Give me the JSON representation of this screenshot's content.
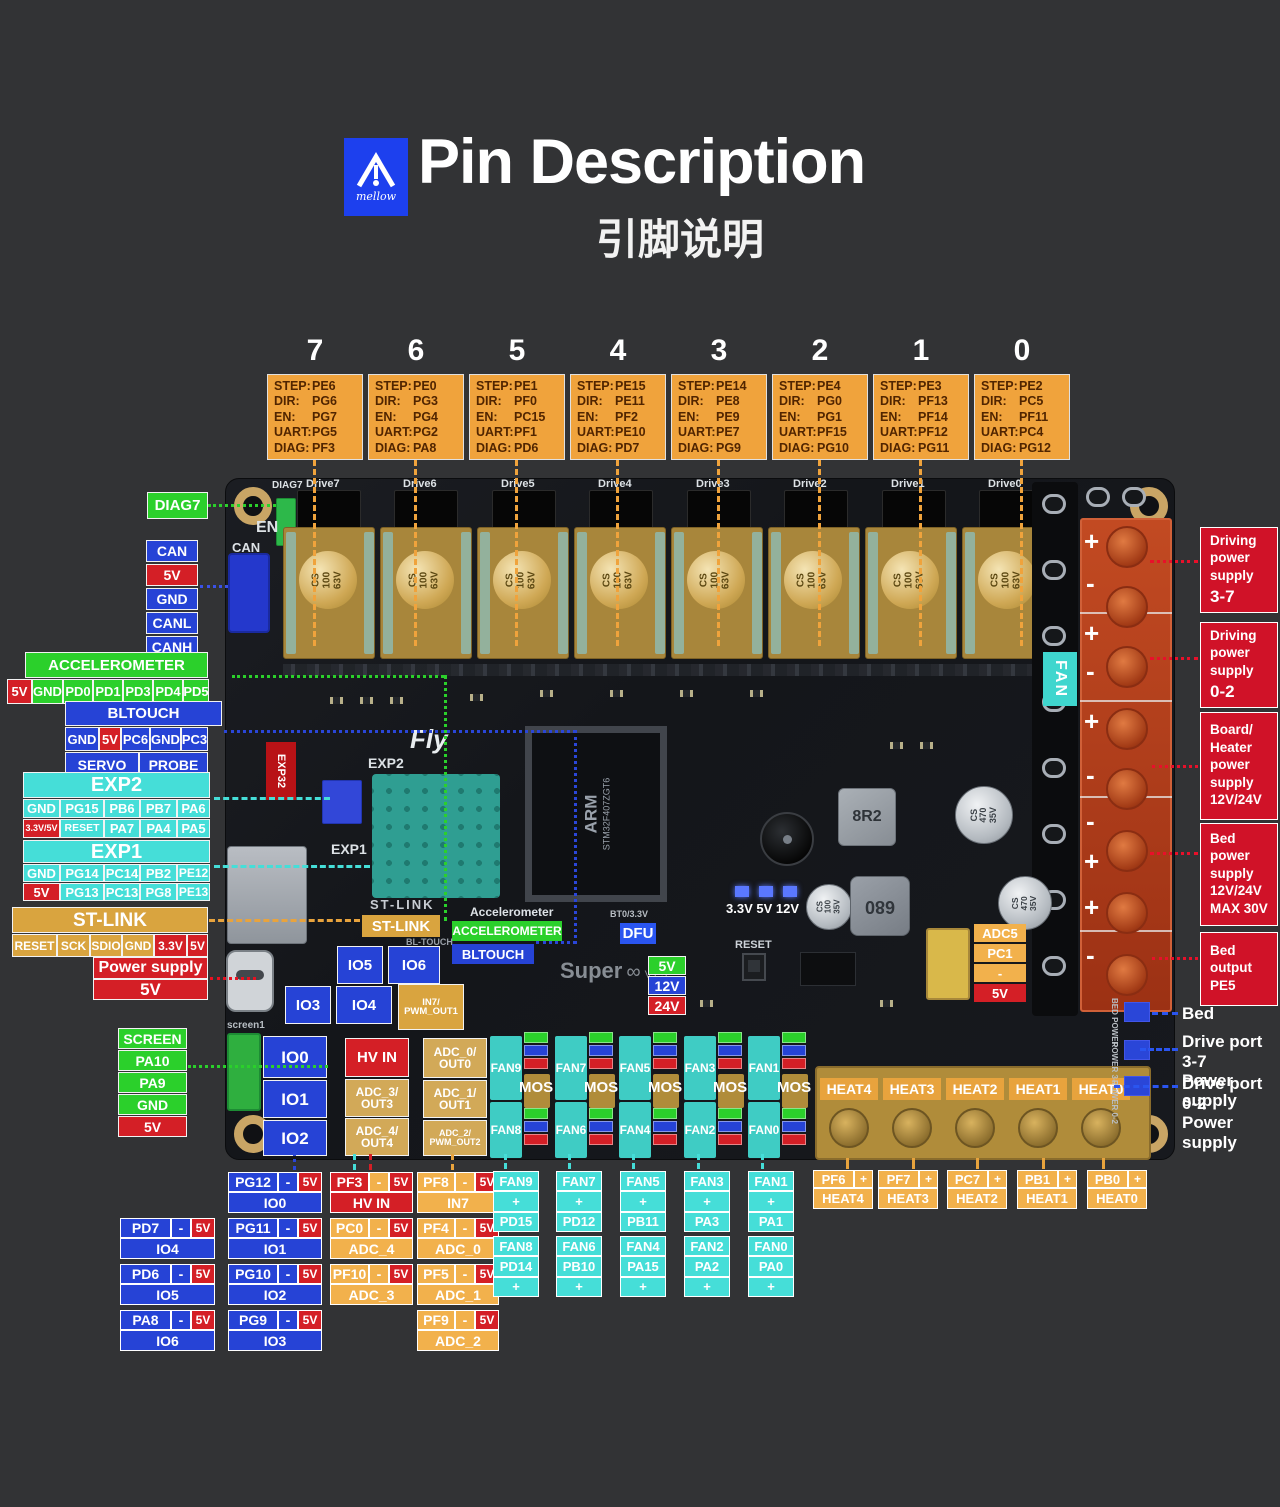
{
  "header": {
    "logo": "mellow",
    "title": "Pin Description",
    "subtitle": "引脚说明"
  },
  "driver_keys": [
    "STEP:",
    "DIR:",
    "EN:",
    "UART:",
    "DIAG:"
  ],
  "drivers": [
    {
      "num": "7",
      "step": "PE6",
      "dir": "PG6",
      "en": "PG7",
      "uart": "PG5",
      "diag": "PF3"
    },
    {
      "num": "6",
      "step": "PE0",
      "dir": "PG3",
      "en": "PG4",
      "uart": "PG2",
      "diag": "PA8"
    },
    {
      "num": "5",
      "step": "PE1",
      "dir": "PF0",
      "en": "PC15",
      "uart": "PF1",
      "diag": "PD6"
    },
    {
      "num": "4",
      "step": "PE15",
      "dir": "PE11",
      "en": "PF2",
      "uart": "PE10",
      "diag": "PD7"
    },
    {
      "num": "3",
      "step": "PE14",
      "dir": "PE8",
      "en": "PE9",
      "uart": "PE7",
      "diag": "PG9"
    },
    {
      "num": "2",
      "step": "PE4",
      "dir": "PG0",
      "en": "PG1",
      "uart": "PF15",
      "diag": "PG10"
    },
    {
      "num": "1",
      "step": "PE3",
      "dir": "PF13",
      "en": "PF14",
      "uart": "PF12",
      "diag": "PG11"
    },
    {
      "num": "0",
      "step": "PE2",
      "dir": "PC5",
      "en": "PF11",
      "uart": "PC4",
      "diag": "PG12"
    }
  ],
  "board": {
    "drive_silk": [
      "Drive7",
      "Drive6",
      "Drive5",
      "Drive4",
      "Drive3",
      "Drive2",
      "Drive1",
      "Drive0"
    ],
    "diag7_silk": "DIAG7",
    "cap_text": "CS\n100\n63V",
    "en_silk": "EN",
    "can_silk": "CAN",
    "fly": "Fly",
    "exp32": "EXP32",
    "exp2_silk": "EXP2",
    "exp1_silk": "EXP1",
    "stlink_silk": "ST-LINK",
    "stlink_label": "ST-LINK",
    "accel_silk": "Accelerometer",
    "accel_label": "ACCELEROMETER",
    "bltouch_label": "BLTOUCH",
    "bltouch_silk": "BL-TOUCH",
    "bt0_silk": "BT0/3.3V",
    "dfu": "DFU",
    "super": "Super",
    "infinity": "∞",
    "version": "V1.3",
    "leds": "3.3V 5V 12V",
    "reset_silk": "RESET",
    "screen1_silk": "screen1",
    "mcu": "STM32F407ZGT6",
    "arm": "ARM",
    "ind1": "8R2",
    "ind2": "680",
    "cap470": "CS\n470\n35V",
    "cap100": "CS\n100\n35V",
    "fan_label": "FAN",
    "v5": "5V",
    "v12": "12V",
    "v24": "24V",
    "adc5": [
      "ADC5",
      "PC1",
      "-",
      "5V"
    ],
    "io": {
      "io0": "IO0",
      "io1": "IO1",
      "io2": "IO2",
      "io3": "IO3",
      "io4": "IO4",
      "io5": "IO5",
      "io6": "IO6"
    },
    "hvin": "HV IN",
    "in7": "IN7/\nPWM_OUT1",
    "adc0": "ADC_0/\nOUT0",
    "adc1": "ADC_1/\nOUT1",
    "adc2": "ADC_2/\nPWM_OUT2",
    "adc3": "ADC_3/\nOUT3",
    "adc4": "ADC_4/\nOUT4",
    "fans_top": [
      "FAN9",
      "FAN7",
      "FAN5",
      "FAN3",
      "FAN1"
    ],
    "fans_bottom": [
      "FAN8",
      "FAN6",
      "FAN4",
      "FAN2",
      "FAN0"
    ],
    "mos": "MOS",
    "heats": [
      "HEAT4",
      "HEAT3",
      "HEAT2",
      "HEAT1",
      "HEAT0"
    ],
    "bed_silk": "BED POWER",
    "p37_silk": "POWER 3-7",
    "p02_silk": "POWER 0-2",
    "plus": "+",
    "minus": "-"
  },
  "left": {
    "diag7": "DIAG7",
    "can": [
      "CAN",
      "5V",
      "GND",
      "CANL",
      "CANH"
    ],
    "accel": {
      "title": "ACCELEROMETER",
      "pins": [
        "5V",
        "GND",
        "PD0",
        "PD1",
        "PD3",
        "PD4",
        "PD5"
      ]
    },
    "bltouch": {
      "title": "BLTOUCH",
      "pins": [
        "GND",
        "5V",
        "PC6",
        "GND",
        "PC3"
      ],
      "servo": "SERVO",
      "probe": "PROBE"
    },
    "exp2": {
      "title": "EXP2",
      "row1": [
        "GND",
        "PG15",
        "PB6",
        "PB7",
        "PA6"
      ],
      "row2": [
        "3.3V/5V",
        "RESET",
        "PA7",
        "PA4",
        "PA5"
      ]
    },
    "exp1": {
      "title": "EXP1",
      "row1": [
        "GND",
        "PG14",
        "PC14",
        "PB2",
        "PE12"
      ],
      "row2": [
        "5V",
        "PG13",
        "PC13",
        "PG8",
        "PE13"
      ]
    },
    "stlink": {
      "title": "ST-LINK",
      "pins": [
        "RESET",
        "SCK",
        "SDIO",
        "GND",
        "3.3V",
        "5V"
      ]
    },
    "power": {
      "title": "Power supply",
      "value": "5V"
    },
    "screen": [
      "SCREEN",
      "PA10",
      "PA9",
      "GND",
      "5V"
    ]
  },
  "right": {
    "boxes": [
      {
        "text": "Driving\npower\nsupply",
        "big": "3-7"
      },
      {
        "text": "Driving\npower\nsupply",
        "big": "0-2"
      },
      {
        "text": "Board/\nHeater\npower\nsupply\n12V/24V",
        "big": ""
      },
      {
        "text": "Bed\npower\nsupply\n12V/24V\nMAX 30V",
        "big": ""
      },
      {
        "text": "Bed\noutput\nPE5",
        "big": ""
      }
    ],
    "bed": "Bed",
    "dp37": "Drive port 3-7\nPower supply",
    "dp02": "Drive port 0-2\nPower supply"
  },
  "bottom": {
    "dash": "-",
    "v5": "5V",
    "plus": "+",
    "io_left": [
      {
        "pin": "PD7",
        "name": "IO4"
      },
      {
        "pin": "PD6",
        "name": "IO5"
      },
      {
        "pin": "PA8",
        "name": "IO6"
      }
    ],
    "io_right": [
      {
        "pin": "PG12",
        "name": "IO0"
      },
      {
        "pin": "PG11",
        "name": "IO1"
      },
      {
        "pin": "PG10",
        "name": "IO2"
      },
      {
        "pin": "PG9",
        "name": "IO3"
      }
    ],
    "adc_left": [
      {
        "pin": "PF3",
        "name": "HV IN"
      },
      {
        "pin": "PC0",
        "name": "ADC_4"
      },
      {
        "pin": "PF10",
        "name": "ADC_3"
      }
    ],
    "adc_right": [
      {
        "pin": "PF8",
        "name": "IN7"
      },
      {
        "pin": "PF4",
        "name": "ADC_0"
      },
      {
        "pin": "PF5",
        "name": "ADC_1"
      },
      {
        "pin": "PF9",
        "name": "ADC_2"
      }
    ],
    "fans_top": [
      {
        "name": "FAN9",
        "pin": "PD15"
      },
      {
        "name": "FAN7",
        "pin": "PD12"
      },
      {
        "name": "FAN5",
        "pin": "PB11"
      },
      {
        "name": "FAN3",
        "pin": "PA3"
      },
      {
        "name": "FAN1",
        "pin": "PA1"
      }
    ],
    "fans_bottom": [
      {
        "name": "FAN8",
        "pin": "PD14"
      },
      {
        "name": "FAN6",
        "pin": "PB10"
      },
      {
        "name": "FAN4",
        "pin": "PA15"
      },
      {
        "name": "FAN2",
        "pin": "PA2"
      },
      {
        "name": "FAN0",
        "pin": "PA0"
      }
    ],
    "heats": [
      {
        "pin": "PF6",
        "name": "HEAT4"
      },
      {
        "pin": "PF7",
        "name": "HEAT3"
      },
      {
        "pin": "PC7",
        "name": "HEAT2"
      },
      {
        "pin": "PB1",
        "name": "HEAT1"
      },
      {
        "pin": "PB0",
        "name": "HEAT0"
      }
    ]
  }
}
